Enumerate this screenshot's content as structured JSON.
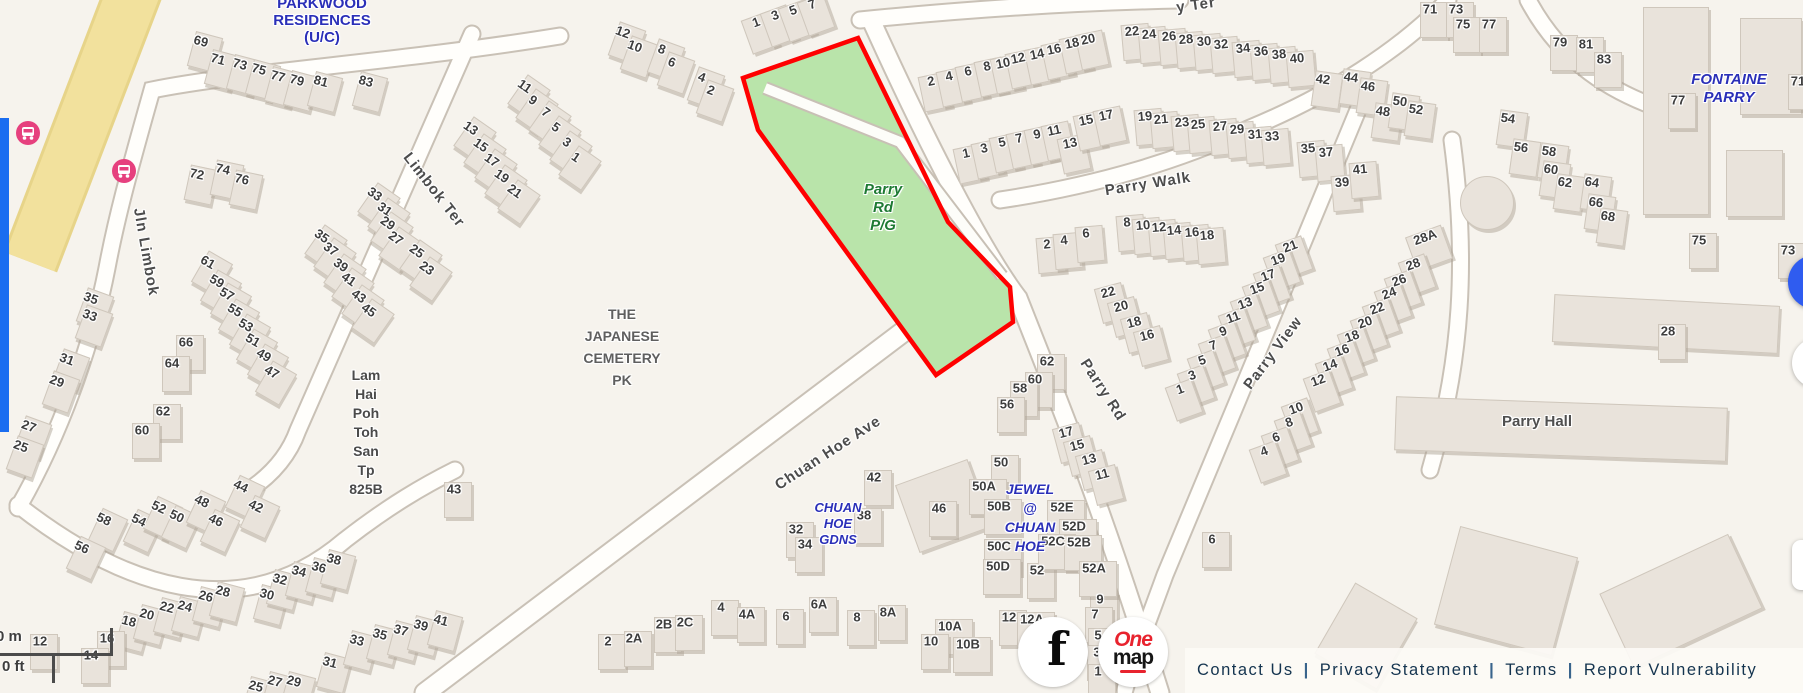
{
  "map": {
    "colors": {
      "background": "#f6f3ed",
      "park_green": "#b9e4aa",
      "selection_red": "#ff0000",
      "transit_pink": "#e6407e",
      "road_yellow": "#f2e19d",
      "estate_label_blue": "#2a2fb8",
      "park_label_green": "#1e7a33",
      "panel_blue": "#1a6df0",
      "control_blue": "#2f5cf0"
    },
    "areas": [
      {
        "lines": [
          "PARKWOOD",
          "RESIDENCES",
          "(U/C)"
        ],
        "x": 322,
        "y": -5,
        "lh": 17,
        "size": 15,
        "color": "#2a2fb8",
        "italic": false
      },
      {
        "lines": [
          "FONTAINE",
          "PARRY"
        ],
        "x": 1729,
        "y": 71,
        "lh": 18,
        "size": 15,
        "color": "#2a2fb8",
        "italic": true
      },
      {
        "lines": [
          "THE",
          "JAPANESE",
          "CEMETERY",
          "PK"
        ],
        "x": 622,
        "y": 303,
        "lh": 22,
        "size": 14,
        "color": "#5f5f5f",
        "italic": false
      },
      {
        "lines": [
          "Lam",
          "Hai",
          "Poh",
          "Toh",
          "San",
          "Tp",
          "825B"
        ],
        "x": 366,
        "y": 366,
        "lh": 19,
        "size": 14,
        "color": "#4a4a4a",
        "italic": false
      },
      {
        "lines": [
          "CHUAN",
          "HOE",
          "GDNS"
        ],
        "x": 838,
        "y": 500,
        "lh": 16,
        "size": 13,
        "color": "#2a2fb8",
        "italic": true
      },
      {
        "lines": [
          "JEWEL",
          "@",
          "CHUAN",
          "HOE"
        ],
        "x": 1030,
        "y": 480,
        "lh": 19,
        "size": 14,
        "color": "#2a2fb8",
        "italic": true
      },
      {
        "lines": [
          "Parry",
          "Rd",
          "P/G"
        ],
        "x": 883,
        "y": 181,
        "lh": 18,
        "size": 15,
        "color": "#1e7a33",
        "italic": true
      },
      {
        "lines": [
          "Parry Hall"
        ],
        "x": 1537,
        "y": 414,
        "lh": 16,
        "size": 15,
        "color": "#4f4f4f",
        "italic": false
      }
    ],
    "streets": [
      {
        "t": "Jln Limbok",
        "x": 146,
        "y": 252,
        "r": 80
      },
      {
        "t": "Limbok Ter",
        "x": 434,
        "y": 190,
        "r": 52
      },
      {
        "t": "Chuan Hoe Ave",
        "x": 828,
        "y": 453,
        "r": -33
      },
      {
        "t": "Parry Walk",
        "x": 1148,
        "y": 184,
        "r": -9
      },
      {
        "t": "Parry Rd",
        "x": 1103,
        "y": 390,
        "r": 57
      },
      {
        "t": "Parry View",
        "x": 1273,
        "y": 353,
        "r": -53
      },
      {
        "t": "y Ter",
        "x": 1196,
        "y": 5,
        "r": -8
      }
    ],
    "numbers": [
      [
        "69",
        201,
        41,
        15
      ],
      [
        "71",
        218,
        59,
        15
      ],
      [
        "73",
        240,
        64,
        15
      ],
      [
        "75",
        259,
        69,
        15
      ],
      [
        "77",
        278,
        76,
        15
      ],
      [
        "79",
        297,
        80,
        15
      ],
      [
        "81",
        321,
        81,
        15
      ],
      [
        "83",
        366,
        81,
        15
      ],
      [
        "72",
        197,
        174,
        12
      ],
      [
        "74",
        223,
        169,
        12
      ],
      [
        "76",
        242,
        179,
        12
      ],
      [
        "11",
        525,
        86,
        35
      ],
      [
        "9",
        533,
        100,
        35
      ],
      [
        "7",
        546,
        112,
        35
      ],
      [
        "5",
        556,
        127,
        35
      ],
      [
        "3",
        567,
        142,
        35
      ],
      [
        "1",
        576,
        157,
        35
      ],
      [
        "13",
        471,
        128,
        35
      ],
      [
        "15",
        481,
        145,
        35
      ],
      [
        "17",
        492,
        160,
        35
      ],
      [
        "19",
        502,
        176,
        35
      ],
      [
        "21",
        515,
        191,
        35
      ],
      [
        "33",
        375,
        194,
        35
      ],
      [
        "31",
        385,
        209,
        35
      ],
      [
        "29",
        388,
        223,
        35
      ],
      [
        "27",
        396,
        238,
        35
      ],
      [
        "25",
        417,
        251,
        35
      ],
      [
        "23",
        427,
        268,
        35
      ],
      [
        "35",
        322,
        236,
        35
      ],
      [
        "37",
        331,
        249,
        35
      ],
      [
        "39",
        341,
        265,
        35
      ],
      [
        "41",
        349,
        279,
        35
      ],
      [
        "43",
        359,
        296,
        35
      ],
      [
        "45",
        369,
        310,
        35
      ],
      [
        "35",
        91,
        298,
        20
      ],
      [
        "33",
        90,
        315,
        20
      ],
      [
        "31",
        67,
        359,
        20
      ],
      [
        "29",
        57,
        381,
        20
      ],
      [
        "27",
        29,
        426,
        20
      ],
      [
        "25",
        21,
        446,
        20
      ],
      [
        "61",
        208,
        262,
        30
      ],
      [
        "59",
        217,
        281,
        30
      ],
      [
        "57",
        227,
        294,
        30
      ],
      [
        "55",
        235,
        310,
        30
      ],
      [
        "53",
        246,
        325,
        30
      ],
      [
        "51",
        253,
        340,
        30
      ],
      [
        "49",
        264,
        355,
        30
      ],
      [
        "47",
        272,
        372,
        30
      ],
      [
        "66",
        186,
        342,
        0
      ],
      [
        "64",
        172,
        363,
        0
      ],
      [
        "62",
        163,
        411,
        0
      ],
      [
        "60",
        142,
        430,
        0
      ],
      [
        "12",
        623,
        32,
        20
      ],
      [
        "10",
        635,
        46,
        20
      ],
      [
        "8",
        662,
        49,
        20
      ],
      [
        "6",
        672,
        62,
        20
      ],
      [
        "4",
        702,
        77,
        20
      ],
      [
        "2",
        711,
        90,
        20
      ],
      [
        "1",
        756,
        22,
        -20
      ],
      [
        "3",
        775,
        15,
        -20
      ],
      [
        "5",
        793,
        10,
        -20
      ],
      [
        "7",
        812,
        4,
        -20
      ],
      [
        "2",
        931,
        81,
        -12
      ],
      [
        "4",
        949,
        76,
        -12
      ],
      [
        "6",
        968,
        71,
        -12
      ],
      [
        "8",
        987,
        66,
        -12
      ],
      [
        "10",
        1003,
        63,
        -12
      ],
      [
        "12",
        1018,
        58,
        -12
      ],
      [
        "14",
        1037,
        54,
        -12
      ],
      [
        "16",
        1054,
        49,
        -12
      ],
      [
        "18",
        1072,
        43,
        -12
      ],
      [
        "20",
        1088,
        39,
        -12
      ],
      [
        "1",
        966,
        153,
        -12
      ],
      [
        "3",
        984,
        148,
        -12
      ],
      [
        "5",
        1002,
        142,
        -12
      ],
      [
        "7",
        1019,
        138,
        -12
      ],
      [
        "9",
        1037,
        134,
        -12
      ],
      [
        "11",
        1054,
        130,
        -12
      ],
      [
        "13",
        1070,
        143,
        -12
      ],
      [
        "15",
        1086,
        120,
        -12
      ],
      [
        "17",
        1106,
        115,
        -12
      ],
      [
        "22",
        1132,
        31,
        -5
      ],
      [
        "24",
        1149,
        34,
        -5
      ],
      [
        "26",
        1169,
        36,
        -5
      ],
      [
        "28",
        1186,
        39,
        -5
      ],
      [
        "30",
        1204,
        41,
        -5
      ],
      [
        "32",
        1221,
        44,
        -5
      ],
      [
        "34",
        1243,
        48,
        -5
      ],
      [
        "36",
        1261,
        51,
        -5
      ],
      [
        "38",
        1279,
        54,
        -5
      ],
      [
        "40",
        1297,
        58,
        -5
      ],
      [
        "19",
        1145,
        116,
        -5
      ],
      [
        "21",
        1161,
        119,
        -5
      ],
      [
        "23",
        1182,
        122,
        -5
      ],
      [
        "25",
        1198,
        124,
        -5
      ],
      [
        "27",
        1220,
        126,
        -5
      ],
      [
        "29",
        1237,
        129,
        -5
      ],
      [
        "31",
        1255,
        134,
        -5
      ],
      [
        "33",
        1272,
        136,
        -5
      ],
      [
        "35",
        1308,
        148,
        -5
      ],
      [
        "37",
        1326,
        152,
        -5
      ],
      [
        "39",
        1342,
        182,
        -5
      ],
      [
        "41",
        1360,
        169,
        -5
      ],
      [
        "42",
        1323,
        79,
        8
      ],
      [
        "44",
        1351,
        77,
        8
      ],
      [
        "46",
        1368,
        86,
        8
      ],
      [
        "48",
        1383,
        111,
        8
      ],
      [
        "50",
        1400,
        101,
        8
      ],
      [
        "52",
        1416,
        109,
        8
      ],
      [
        "71",
        1430,
        9,
        0
      ],
      [
        "73",
        1456,
        9,
        0
      ],
      [
        "75",
        1463,
        24,
        0
      ],
      [
        "77",
        1489,
        24,
        0
      ],
      [
        "79",
        1560,
        42,
        0
      ],
      [
        "81",
        1586,
        44,
        0
      ],
      [
        "83",
        1604,
        59,
        0
      ],
      [
        "54",
        1508,
        118,
        8
      ],
      [
        "56",
        1521,
        147,
        8
      ],
      [
        "58",
        1549,
        151,
        8
      ],
      [
        "60",
        1551,
        169,
        8
      ],
      [
        "62",
        1565,
        182,
        8
      ],
      [
        "64",
        1592,
        182,
        8
      ],
      [
        "66",
        1596,
        202,
        8
      ],
      [
        "68",
        1608,
        216,
        8
      ],
      [
        "77",
        1678,
        100,
        0
      ],
      [
        "71",
        1798,
        81,
        0
      ],
      [
        "75",
        1699,
        240,
        0
      ],
      [
        "73",
        1788,
        250,
        0
      ],
      [
        "28A",
        1425,
        237,
        -20
      ],
      [
        "28",
        1413,
        264,
        -20
      ],
      [
        "26",
        1399,
        280,
        -20
      ],
      [
        "24",
        1389,
        293,
        -20
      ],
      [
        "22",
        1377,
        308,
        -20
      ],
      [
        "20",
        1365,
        322,
        -20
      ],
      [
        "18",
        1352,
        336,
        -20
      ],
      [
        "16",
        1342,
        350,
        -20
      ],
      [
        "14",
        1330,
        365,
        -20
      ],
      [
        "12",
        1318,
        380,
        -20
      ],
      [
        "10",
        1296,
        408,
        -20
      ],
      [
        "8",
        1289,
        422,
        -20
      ],
      [
        "6",
        1276,
        437,
        -20
      ],
      [
        "4",
        1264,
        451,
        -20
      ],
      [
        "21",
        1290,
        246,
        -20
      ],
      [
        "19",
        1278,
        259,
        -20
      ],
      [
        "17",
        1268,
        275,
        -20
      ],
      [
        "15",
        1257,
        288,
        -20
      ],
      [
        "13",
        1245,
        303,
        -20
      ],
      [
        "11",
        1233,
        317,
        -20
      ],
      [
        "9",
        1223,
        331,
        -20
      ],
      [
        "7",
        1213,
        345,
        -20
      ],
      [
        "5",
        1202,
        360,
        -20
      ],
      [
        "3",
        1192,
        375,
        -20
      ],
      [
        "1",
        1180,
        389,
        -20
      ],
      [
        "2",
        1047,
        244,
        -5
      ],
      [
        "4",
        1064,
        240,
        -5
      ],
      [
        "6",
        1086,
        233,
        -5
      ],
      [
        "8",
        1127,
        222,
        -5
      ],
      [
        "10",
        1143,
        225,
        -5
      ],
      [
        "12",
        1159,
        227,
        -5
      ],
      [
        "14",
        1174,
        230,
        -5
      ],
      [
        "16",
        1192,
        232,
        -5
      ],
      [
        "18",
        1207,
        235,
        -5
      ],
      [
        "22",
        1108,
        292,
        -15
      ],
      [
        "20",
        1121,
        306,
        -15
      ],
      [
        "18",
        1134,
        322,
        -15
      ],
      [
        "16",
        1147,
        335,
        -15
      ],
      [
        "62",
        1047,
        361,
        0
      ],
      [
        "60",
        1035,
        379,
        0
      ],
      [
        "58",
        1020,
        388,
        0
      ],
      [
        "56",
        1007,
        404,
        0
      ],
      [
        "17",
        1066,
        432,
        -15
      ],
      [
        "15",
        1077,
        445,
        -15
      ],
      [
        "13",
        1089,
        459,
        -15
      ],
      [
        "11",
        1102,
        474,
        -15
      ],
      [
        "9",
        1100,
        599,
        0
      ],
      [
        "7",
        1095,
        614,
        0
      ],
      [
        "5",
        1098,
        635,
        0
      ],
      [
        "3",
        1097,
        652,
        0
      ],
      [
        "1",
        1098,
        671,
        0
      ],
      [
        "28",
        1668,
        331,
        0
      ],
      [
        "42",
        874,
        477,
        0
      ],
      [
        "38",
        864,
        515,
        0
      ],
      [
        "32",
        796,
        529,
        0
      ],
      [
        "34",
        805,
        544,
        0
      ],
      [
        "46",
        939,
        508,
        0
      ],
      [
        "50",
        1001,
        462,
        0
      ],
      [
        "50A",
        984,
        486,
        0
      ],
      [
        "50B",
        999,
        506,
        0
      ],
      [
        "50C",
        999,
        546,
        0
      ],
      [
        "50D",
        998,
        566,
        0
      ],
      [
        "52",
        1037,
        570,
        0
      ],
      [
        "52E",
        1062,
        507,
        0
      ],
      [
        "52D",
        1074,
        526,
        0
      ],
      [
        "52C",
        1053,
        541,
        0
      ],
      [
        "52B",
        1079,
        542,
        0
      ],
      [
        "52A",
        1094,
        568,
        0
      ],
      [
        "2",
        608,
        641,
        0
      ],
      [
        "2A",
        634,
        638,
        0
      ],
      [
        "2B",
        664,
        624,
        0
      ],
      [
        "2C",
        685,
        622,
        0
      ],
      [
        "4",
        721,
        607,
        0
      ],
      [
        "4A",
        747,
        614,
        0
      ],
      [
        "6",
        786,
        616,
        0
      ],
      [
        "6A",
        819,
        604,
        0
      ],
      [
        "8",
        857,
        617,
        0
      ],
      [
        "8A",
        888,
        612,
        0
      ],
      [
        "10A",
        950,
        626,
        0
      ],
      [
        "10",
        931,
        641,
        0
      ],
      [
        "10B",
        968,
        644,
        0
      ],
      [
        "12",
        1009,
        617,
        0
      ],
      [
        "12A",
        1032,
        619,
        0
      ],
      [
        "6",
        1212,
        539,
        0
      ],
      [
        "58",
        104,
        519,
        25
      ],
      [
        "56",
        82,
        547,
        25
      ],
      [
        "54",
        139,
        520,
        25
      ],
      [
        "52",
        159,
        507,
        25
      ],
      [
        "50",
        177,
        516,
        25
      ],
      [
        "48",
        202,
        501,
        25
      ],
      [
        "46",
        216,
        520,
        25
      ],
      [
        "44",
        241,
        486,
        25
      ],
      [
        "42",
        256,
        506,
        25
      ],
      [
        "18",
        129,
        621,
        15
      ],
      [
        "20",
        147,
        614,
        15
      ],
      [
        "22",
        167,
        607,
        15
      ],
      [
        "24",
        185,
        606,
        15
      ],
      [
        "26",
        206,
        596,
        15
      ],
      [
        "28",
        223,
        591,
        15
      ],
      [
        "30",
        267,
        594,
        15
      ],
      [
        "32",
        280,
        579,
        15
      ],
      [
        "34",
        299,
        571,
        15
      ],
      [
        "36",
        319,
        567,
        15
      ],
      [
        "38",
        334,
        559,
        15
      ],
      [
        "25",
        256,
        686,
        15
      ],
      [
        "27",
        275,
        681,
        15
      ],
      [
        "29",
        294,
        681,
        15
      ],
      [
        "31",
        330,
        662,
        15
      ],
      [
        "33",
        357,
        640,
        15
      ],
      [
        "35",
        380,
        634,
        15
      ],
      [
        "37",
        401,
        630,
        15
      ],
      [
        "39",
        421,
        625,
        15
      ],
      [
        "41",
        441,
        620,
        15
      ],
      [
        "43",
        454,
        489,
        0
      ],
      [
        "12",
        40,
        641,
        0
      ],
      [
        "16",
        107,
        638,
        0
      ],
      [
        "14",
        91,
        655,
        0
      ]
    ]
  },
  "scalebar": {
    "meters": "0 m",
    "feet": "0 ft"
  },
  "footer": {
    "separator": "|",
    "links": [
      "Contact Us",
      "Privacy Statement",
      "Terms",
      "Report Vulnerability"
    ]
  },
  "social": {
    "facebook_glyph": "f",
    "onemap_line1": "One",
    "onemap_line2": "map"
  }
}
